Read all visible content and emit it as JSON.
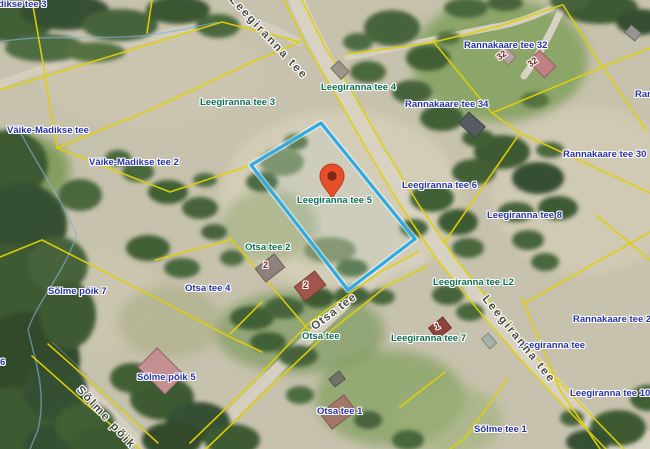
{
  "map": {
    "type": "cadastral-aerial-map",
    "selected_parcel": {
      "address": "Leegiranna tee 5"
    },
    "marker": {
      "kind": "location-pin"
    },
    "colors": {
      "selected_parcel_outline": "#2fabe1",
      "cadastral_line": "#e0d004",
      "address_label_green": "#0a6e52",
      "address_label_blue": "#2633a6",
      "road_label": "#4b4b44",
      "house_number": "#7a241f",
      "marker_fill": "#e64f2a",
      "road_fill": "#d8d2c3"
    },
    "labels": [
      {
        "text": "dikse tee 3",
        "type": "blue",
        "x": -2,
        "y": 0
      },
      {
        "text": "Leegiranna tee",
        "type": "road",
        "x": 231,
        "y": -8,
        "rot": 47,
        "spacing": 2
      },
      {
        "text": "Leegiranna tee 4",
        "type": "green",
        "x": 321,
        "y": 83
      },
      {
        "text": "Leegiranna tee 3",
        "type": "green",
        "x": 200,
        "y": 98
      },
      {
        "text": "Rannakaare tee 32",
        "type": "blue",
        "x": 464,
        "y": 41
      },
      {
        "text": "Rannakaare tee 34",
        "type": "blue",
        "x": 405,
        "y": 100
      },
      {
        "text": "Ran",
        "type": "blue",
        "x": 635,
        "y": 90
      },
      {
        "text": "Rannakaare tee 30",
        "type": "blue",
        "x": 563,
        "y": 150
      },
      {
        "text": "Väike-Madikse tee",
        "type": "blue",
        "x": 7,
        "y": 126
      },
      {
        "text": "Väike-Madikse tee 2",
        "type": "blue",
        "x": 89,
        "y": 158
      },
      {
        "text": "Leegiranna tee 6",
        "type": "blue",
        "x": 402,
        "y": 181
      },
      {
        "text": "Leegiranna tee 8",
        "type": "blue",
        "x": 487,
        "y": 211
      },
      {
        "text": "Leegiranna tee 5",
        "type": "green",
        "x": 297,
        "y": 196
      },
      {
        "text": "Otsa tee 2",
        "type": "green",
        "x": 245,
        "y": 243
      },
      {
        "text": "Otsa tee 4",
        "type": "blue",
        "x": 185,
        "y": 284
      },
      {
        "text": "Sõlme põik 7",
        "type": "blue",
        "x": 48,
        "y": 287
      },
      {
        "text": "Leegiranna tee L2",
        "type": "green",
        "x": 433,
        "y": 278
      },
      {
        "text": "Rannakaare tee 2",
        "type": "blue",
        "x": 573,
        "y": 315
      },
      {
        "text": "Leegiranna tee",
        "type": "blue",
        "x": 518,
        "y": 341
      },
      {
        "text": "Leegiranna tee 7",
        "type": "green",
        "x": 391,
        "y": 334
      },
      {
        "text": "Otsa tee",
        "type": "green",
        "x": 302,
        "y": 332
      },
      {
        "text": "Otsa tee",
        "type": "road",
        "x": 313,
        "y": 322,
        "rot": -37,
        "spacing": 1
      },
      {
        "text": "Leegiranna tee",
        "type": "road",
        "x": 484,
        "y": 291,
        "rot": 51,
        "spacing": 2
      },
      {
        "text": "Otsa tee 1",
        "type": "blue",
        "x": 317,
        "y": 407
      },
      {
        "text": "Leegiranna tee 10",
        "type": "blue",
        "x": 570,
        "y": 389
      },
      {
        "text": "Sõlme tee 1",
        "type": "blue",
        "x": 474,
        "y": 425
      },
      {
        "text": "Sõlme põik 5",
        "type": "blue",
        "x": 137,
        "y": 373
      },
      {
        "text": "Sõlme põik",
        "type": "road",
        "x": 78,
        "y": 382,
        "rot": 47,
        "spacing": 2
      },
      {
        "text": "6",
        "type": "blue",
        "x": 0,
        "y": 358
      },
      {
        "text": "2",
        "type": "house",
        "x": 263,
        "y": 261
      },
      {
        "text": "2",
        "type": "house",
        "x": 303,
        "y": 281
      },
      {
        "text": "1",
        "type": "house",
        "x": 435,
        "y": 322,
        "rot": -20
      },
      {
        "text": "32",
        "type": "house",
        "x": 528,
        "y": 58,
        "rot": -35
      },
      {
        "text": "32",
        "type": "house",
        "x": 497,
        "y": 51,
        "rot": -35
      }
    ]
  }
}
